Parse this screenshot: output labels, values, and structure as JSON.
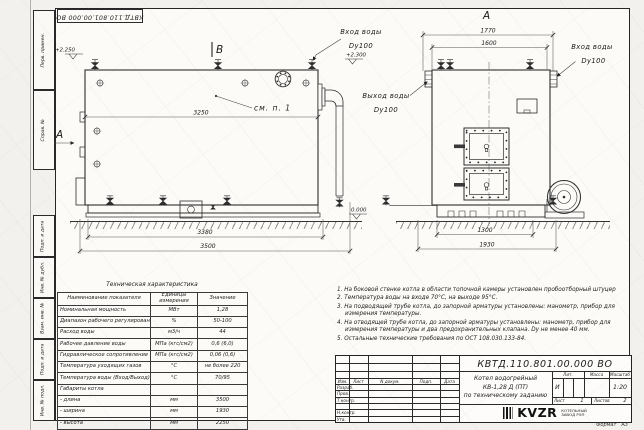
{
  "sheet": {
    "corner_stamp": "КВТД.110.801.00.000 ВО",
    "format_label": "Формат",
    "format_value": "А3",
    "margin_labels": [
      "Перв. примен.",
      "Справ. №",
      "Подп. и дата",
      "Инв. № дубл.",
      "Взам. инв. №",
      "Подп. и дата",
      "Инв. № подл."
    ]
  },
  "views": {
    "side": {
      "section_label": "B",
      "view_label": "A",
      "detail_ref": "см. п. 1",
      "elev_top": "+2.250",
      "elev_pipe": "+2.300",
      "elev_ground": "0.000",
      "dim_body": "3250",
      "dim_base": "3380",
      "dim_overall": "3500",
      "inlet_title": "Вход воды",
      "inlet_size": "Dy100",
      "outlet_title": "Выход воды",
      "outlet_size": "Dy100"
    },
    "front": {
      "view_label": "A",
      "dim_overall_top": "1770",
      "dim_body_top": "1600",
      "dim_base": "1300",
      "dim_overall_bottom": "1930",
      "inlet_title": "Вход воды",
      "inlet_size": "Dy100"
    }
  },
  "spec_table": {
    "title": "Техническая характеристика",
    "headers": [
      "Наименование показателя",
      "Единицы измерения",
      "Значение"
    ],
    "rows": [
      [
        "Номинальная мощность",
        "МВт",
        "1,28"
      ],
      [
        "Диапазон рабочего регулирования",
        "%",
        "50-100"
      ],
      [
        "Расход воды",
        "м3/ч",
        "44"
      ],
      [
        "Рабочее давление воды",
        "МПа (кгс/см2)",
        "0,6 (6,0)"
      ],
      [
        "Гидравлическое сопротивление котла",
        "МПа (кгс/см2)",
        "0,06 (0,6)"
      ],
      [
        "Температура уходящих газов",
        "°С",
        "не более 220"
      ],
      [
        "Температура воды (Вход/Выход)",
        "°С",
        "70/95"
      ],
      [
        "Габариты котла",
        "",
        ""
      ],
      [
        "- длина",
        "мм",
        "3500"
      ],
      [
        "- ширина",
        "мм",
        "1930"
      ],
      [
        "- высота",
        "мм",
        "2250"
      ]
    ]
  },
  "notes": {
    "items": [
      "1.  На боковой стенке котла в области топочной камеры установлен пробоотборный штуцер",
      "2.  Температура воды на входе 70°С, на выходе 95°С.",
      "3.  На подводящей трубе котла, до запорной арматуры установлены: манометр, прибор для измерения температуры.",
      "4.  На отводящей трубе котла, до запорной арматуры установлены: манометр, прибор для измерения температуры и два предохранительных клапана. Dу не менее 40 мм.",
      "5.  Остальные технические требования по ОСТ 108.030.133-84."
    ]
  },
  "title_block": {
    "doc_number": "КВТД.110.801.00.000 ВО",
    "columns": [
      "Изм.",
      "Лист",
      "N докум.",
      "Подп.",
      "Дата"
    ],
    "rows": [
      "Разраб.",
      "Пров.",
      "Т.контр.",
      "",
      "Н.контр.",
      "Утв."
    ],
    "product_title_lines": [
      "Котел водогрейный",
      "КВ-1,28 Д (ПТ)",
      "по техническому заданию"
    ],
    "lit_label": "Лит.",
    "lit_value": "И",
    "mass_label": "Масса",
    "scale_label": "Масштаб",
    "scale_value": "1:20",
    "sheet_label": "Лист",
    "sheet_value": "1",
    "sheets_label": "Листов",
    "sheets_value": "2",
    "logo": "KVZR",
    "company": [
      "КОТЕЛЬНЫЙ",
      "ЗАВОД РЭП"
    ]
  }
}
